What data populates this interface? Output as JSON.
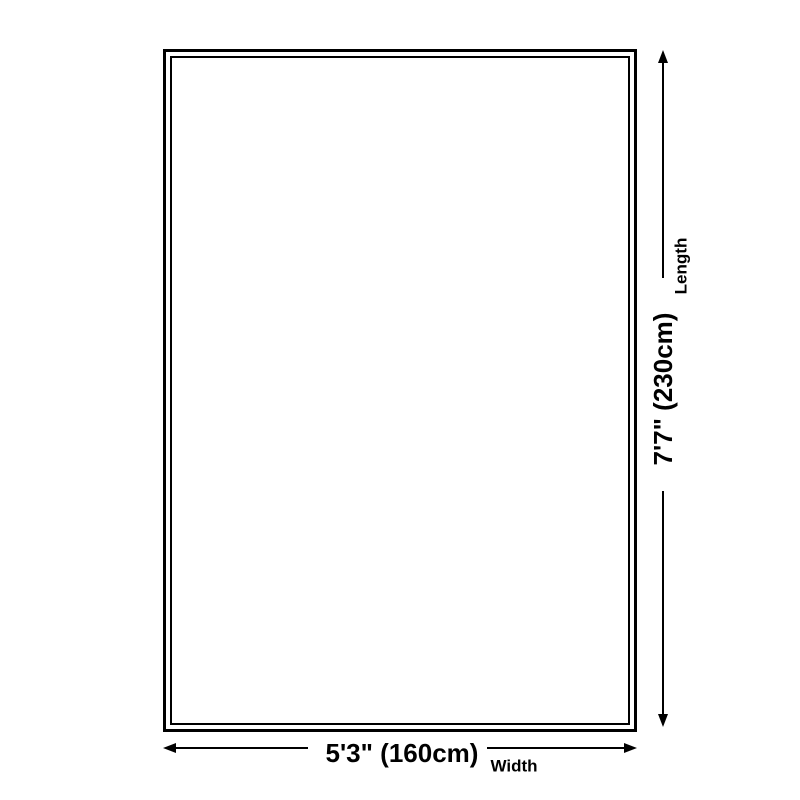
{
  "diagram": {
    "background_color": "#ffffff",
    "line_color": "#000000",
    "length_dimension": {
      "value": "7'7\" (230cm)",
      "label": "Length",
      "orientation": "vertical"
    },
    "width_dimension": {
      "value": "5'3\" (160cm)",
      "label": "Width",
      "orientation": "horizontal"
    }
  }
}
